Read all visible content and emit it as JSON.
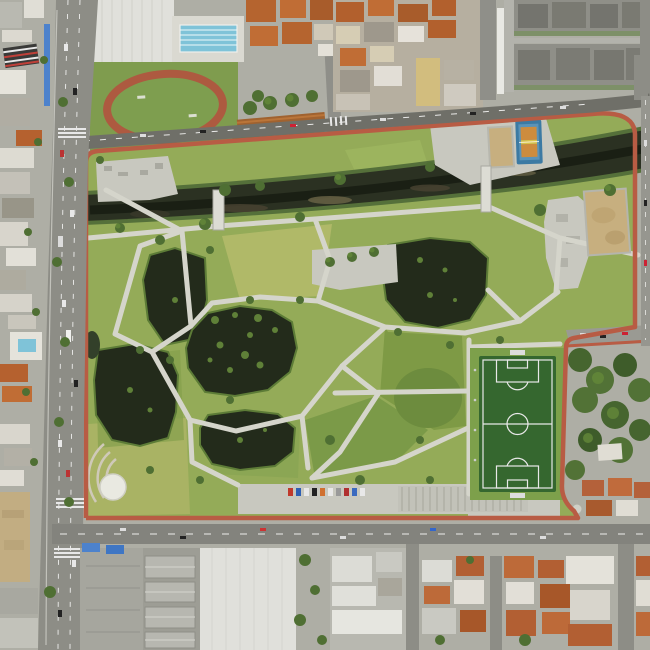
{
  "scene": {
    "type": "aerial-photograph",
    "description": "Top-down drone photo of a large urban park: a dark canal crosses the upper half diagonally, five dark ponds sit among green lawns linked by light concrete paths, a red jogging track rings the perimeter, with a soccer field, basketball court, sand court, skate plaza, helipad circle and athletics oval; the park is surrounded by avenues, orange-roofed houses, white warehouses and gray apartment rows.",
    "time_of_day": "day"
  },
  "palette": {
    "ground": "#aeaea5",
    "grass": "#94ab58",
    "grassLight": "#b2ba6a",
    "grassDark": "#74923f",
    "bank": "#7fa04b",
    "water": "#232b1b",
    "canal": "#2b3122",
    "path": "#d5d5cb",
    "track": "#b85c44",
    "roadDark": "#6f6f68",
    "road": "#8d8d86",
    "asphaltLight": "#a6a69e",
    "paved": "#c8c8bf",
    "field": "#35672f",
    "fieldLine": "#e8e8e8",
    "court": "#3c7aa3",
    "courtInner": "#cd8c3e",
    "sand": "#c7af7f",
    "pool": "#7fc3d8",
    "roofOrange": "#b5612f",
    "roofOrange2": "#c06d35",
    "roofWhite": "#e3e3dd",
    "roofGray": "#a3a39b",
    "apartment": "#8f8f88",
    "apartmentDark": "#70706a",
    "rust": "#a0622f",
    "canopyBlue": "#4d82cc",
    "treeDark": "#4f6f33",
    "tree": "#648839",
    "helipad": "#e9e9e1",
    "dirt": "#c2ad82",
    "warehouse": "#e0e0db"
  },
  "features": [
    {
      "name": "perimeter-jogging-track",
      "color": "#b85c44"
    },
    {
      "name": "canal",
      "color": "#2b3122"
    },
    {
      "name": "pond-northwest",
      "color": "#232b1b"
    },
    {
      "name": "pond-central-with-islands",
      "color": "#232b1b"
    },
    {
      "name": "pond-northeast",
      "color": "#232b1b"
    },
    {
      "name": "pond-southwest",
      "color": "#232b1b"
    },
    {
      "name": "pond-south",
      "color": "#232b1b"
    },
    {
      "name": "soccer-field",
      "color": "#35672f"
    },
    {
      "name": "basketball-court",
      "color": "#3c7aa3"
    },
    {
      "name": "sand-court",
      "color": "#c7af7f"
    },
    {
      "name": "dirt-field",
      "color": "#c7af7f"
    },
    {
      "name": "skate-plaza",
      "color": "#c8c8bf"
    },
    {
      "name": "helipad-circle",
      "color": "#e9e9e1"
    },
    {
      "name": "athletics-oval",
      "color": "#ad5a40"
    },
    {
      "name": "swimming-pool",
      "color": "#7fc3d8"
    },
    {
      "name": "footbridges-over-canal",
      "count": 2
    },
    {
      "name": "west-avenue"
    },
    {
      "name": "north-road"
    },
    {
      "name": "south-road"
    },
    {
      "name": "apartment-blocks-northeast"
    },
    {
      "name": "warehouse-south"
    },
    {
      "name": "parking-lots"
    },
    {
      "name": "orange-roof-neighborhoods"
    }
  ]
}
